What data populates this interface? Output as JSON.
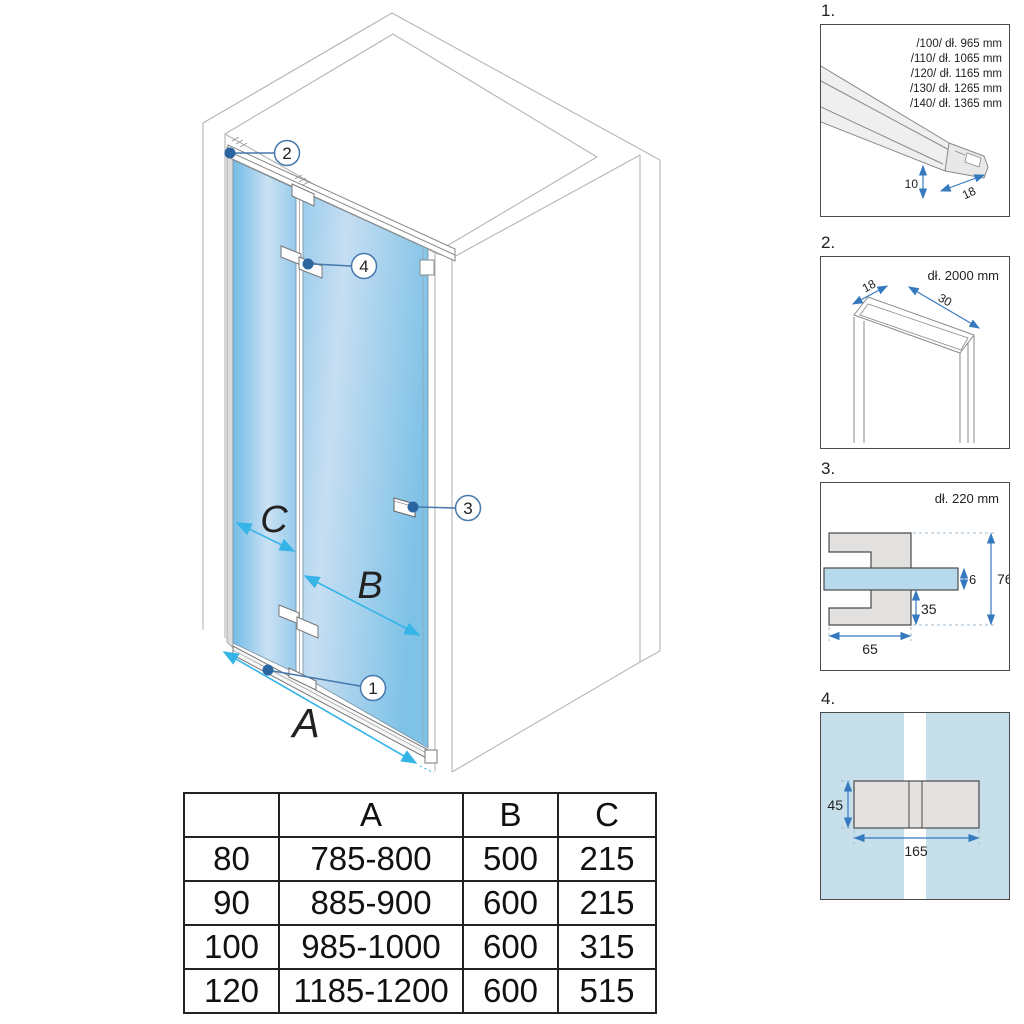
{
  "main": {
    "dim_a": "A",
    "dim_b": "B",
    "dim_c": "C",
    "callout_1": "1",
    "callout_2": "2",
    "callout_3": "3",
    "callout_4": "4"
  },
  "panel1": {
    "title": "1.",
    "sizes": [
      "/100/ dł. 965 mm",
      "/110/ dł. 1065 mm",
      "/120/ dł. 1165 mm",
      "/130/ dł. 1265 mm",
      "/140/ dł. 1365 mm"
    ],
    "dim_height": "10",
    "dim_depth": "18"
  },
  "panel2": {
    "title": "2.",
    "length": "dł. 2000 mm",
    "dim_depth": "18",
    "dim_width": "30"
  },
  "panel3": {
    "title": "3.",
    "length": "dł. 220 mm",
    "dim_glass": "6",
    "dim_total": "76",
    "dim_lower": "35",
    "dim_width": "65"
  },
  "panel4": {
    "title": "4.",
    "dim_height": "45",
    "dim_width": "165"
  },
  "table": {
    "headers": [
      "",
      "A",
      "B",
      "C"
    ],
    "rows": [
      [
        "80",
        "785-800",
        "500",
        "215"
      ],
      [
        "90",
        "885-900",
        "600",
        "215"
      ],
      [
        "100",
        "985-1000",
        "600",
        "315"
      ],
      [
        "120",
        "1185-1200",
        "600",
        "515"
      ]
    ]
  },
  "colors": {
    "glass_blue": "#8cc6e9",
    "glass_light": "#cbe1f3",
    "dimension_cyan": "#35b4e8",
    "callout_blue": "#4678ac",
    "panel_dim_blue": "#3579bf",
    "outline_gray": "#b5b5b5",
    "panel4_background": "#c7dfeb"
  }
}
